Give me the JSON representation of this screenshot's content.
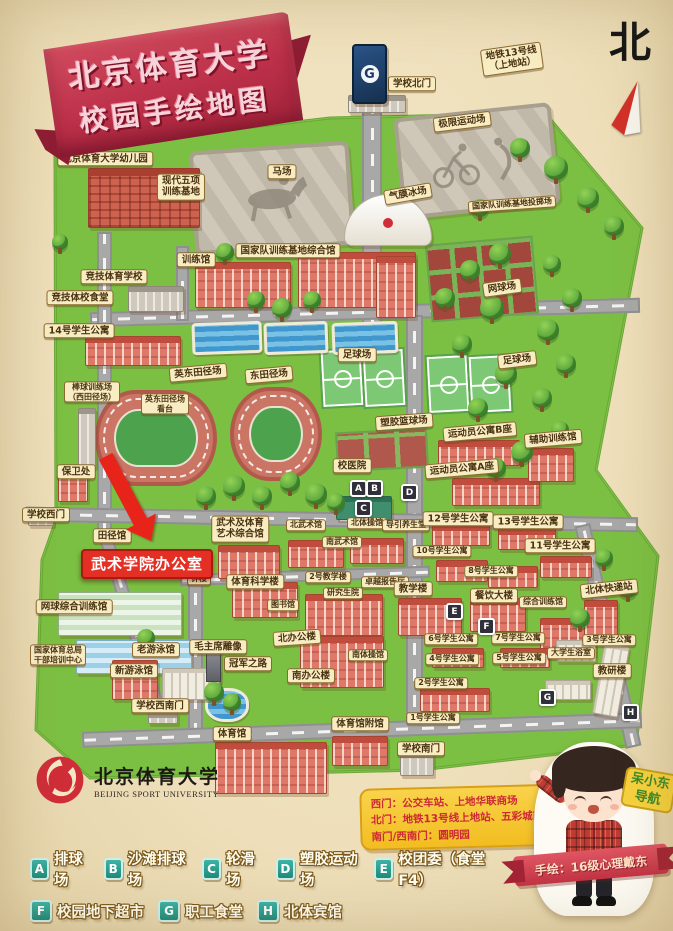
{
  "title": {
    "line1": "北京体育大学",
    "line2": "校园手绘地图"
  },
  "compass": {
    "north_char": "北"
  },
  "metro": {
    "logo": "G",
    "label": "地铁13号线\n（上地站）"
  },
  "logo": {
    "cn": "北京体育大学",
    "en": "BEIJING SPORT UNIVERSITY"
  },
  "gate_info": {
    "lines": [
      "西门：公交车站、上地华联商场",
      "北门：地铁13号线上地站、五彩城商场",
      "南门/西南门：圆明园"
    ]
  },
  "character": {
    "tag": "呆小东\n导航",
    "credit": "手绘：16级心理戴东"
  },
  "legend": {
    "rows": [
      [
        {
          "k": "A",
          "t": "排球场"
        },
        {
          "k": "B",
          "t": "沙滩排球场"
        },
        {
          "k": "C",
          "t": "轮滑场"
        },
        {
          "k": "D",
          "t": "塑胶运动场"
        },
        {
          "k": "E",
          "t": "校团委（食堂F4）"
        }
      ],
      [
        {
          "k": "F",
          "t": "校园地下超市"
        },
        {
          "k": "G",
          "t": "职工食堂"
        },
        {
          "k": "H",
          "t": "北体宾馆"
        }
      ]
    ]
  },
  "colors": {
    "banner_red": "#bc3049",
    "tag_bg": "#f8ecc3",
    "highlight_red": "#e42f24",
    "campus_green": "#7cc043",
    "road_gray": "#a8a8a8",
    "legend_teal": "#2aa198",
    "bubble_yellow": "#f2bd20",
    "bubble_text": "#cc2936",
    "metro_blue": "#1b3a63"
  },
  "map_labels": [
    {
      "text": "北京体育大学幼儿园",
      "x": 105,
      "y": 159
    },
    {
      "text": "现代五项\n训练基地",
      "x": 181,
      "y": 187
    },
    {
      "text": "马场",
      "x": 282,
      "y": 172
    },
    {
      "text": "学校北门",
      "x": 412,
      "y": 84
    },
    {
      "text": "地铁13号线\n（上地站）",
      "x": 512,
      "y": 59,
      "r": -8
    },
    {
      "text": "极限运动场",
      "x": 462,
      "y": 122,
      "r": -7
    },
    {
      "text": "气膜冰场",
      "x": 408,
      "y": 194,
      "r": -10
    },
    {
      "text": "国家队训练基地投掷场",
      "x": 512,
      "y": 204,
      "r": -4,
      "cls": "small"
    },
    {
      "text": "国家队训练基地综合馆",
      "x": 288,
      "y": 251
    },
    {
      "text": "训练馆",
      "x": 196,
      "y": 260
    },
    {
      "text": "竞技体育学校",
      "x": 114,
      "y": 277
    },
    {
      "text": "竞技体校食堂",
      "x": 80,
      "y": 298
    },
    {
      "text": "14号学生公寓",
      "x": 79,
      "y": 331
    },
    {
      "text": "网球场",
      "x": 502,
      "y": 288,
      "r": -8
    },
    {
      "text": "棒球训练场\n（西田径场）",
      "x": 92,
      "y": 392,
      "cls": "small"
    },
    {
      "text": "英东田径场",
      "x": 198,
      "y": 373,
      "r": -5
    },
    {
      "text": "东田径场",
      "x": 269,
      "y": 375,
      "r": -5
    },
    {
      "text": "英东田径场\n看台",
      "x": 165,
      "y": 404,
      "cls": "small"
    },
    {
      "text": "足球场",
      "x": 357,
      "y": 355
    },
    {
      "text": "足球场",
      "x": 517,
      "y": 360,
      "r": -7
    },
    {
      "text": "塑胶篮球场",
      "x": 404,
      "y": 422,
      "r": -4
    },
    {
      "text": "校医院",
      "x": 352,
      "y": 466
    },
    {
      "text": "运动员公寓B座",
      "x": 480,
      "y": 432,
      "r": -5
    },
    {
      "text": "运动员公寓A座",
      "x": 462,
      "y": 469,
      "r": -5
    },
    {
      "text": "辅助训练馆",
      "x": 553,
      "y": 439,
      "r": -5
    },
    {
      "text": "保卫处",
      "x": 76,
      "y": 472
    },
    {
      "text": "学校西门",
      "x": 46,
      "y": 515
    },
    {
      "text": "武术及体育\n艺术综合馆",
      "x": 240,
      "y": 529
    },
    {
      "text": "北武术馆",
      "x": 306,
      "y": 525,
      "cls": "small"
    },
    {
      "text": "北体操馆",
      "x": 367,
      "y": 523,
      "cls": "small"
    },
    {
      "text": "导引养生堂",
      "x": 406,
      "y": 525,
      "cls": "small"
    },
    {
      "text": "南武术馆",
      "x": 342,
      "y": 542,
      "cls": "small"
    },
    {
      "text": "田径馆",
      "x": 112,
      "y": 536
    },
    {
      "text": "钟楼",
      "x": 199,
      "y": 579,
      "cls": "small"
    },
    {
      "text": "体育科学楼",
      "x": 255,
      "y": 582
    },
    {
      "text": "2号教学楼",
      "x": 328,
      "y": 577,
      "cls": "small"
    },
    {
      "text": "卓越报告厅",
      "x": 385,
      "y": 582,
      "cls": "small"
    },
    {
      "text": "研究生院",
      "x": 343,
      "y": 593,
      "cls": "small"
    },
    {
      "text": "图书馆",
      "x": 283,
      "y": 605,
      "cls": "small"
    },
    {
      "text": "教学楼",
      "x": 413,
      "y": 589
    },
    {
      "text": "北办公楼",
      "x": 297,
      "y": 638,
      "r": -4
    },
    {
      "text": "毛主席雕像",
      "x": 218,
      "y": 647
    },
    {
      "text": "冠军之路",
      "x": 248,
      "y": 664
    },
    {
      "text": "南办公楼",
      "x": 311,
      "y": 676
    },
    {
      "text": "南体操馆",
      "x": 368,
      "y": 655,
      "cls": "small"
    },
    {
      "text": "老游泳馆",
      "x": 156,
      "y": 650
    },
    {
      "text": "新游泳馆",
      "x": 134,
      "y": 671
    },
    {
      "text": "网球综合训练馆",
      "x": 74,
      "y": 607
    },
    {
      "text": "国家体育总局\n干部培训中心",
      "x": 58,
      "y": 655,
      "cls": "small"
    },
    {
      "text": "学校西南门",
      "x": 160,
      "y": 706
    },
    {
      "text": "体育馆",
      "x": 232,
      "y": 734
    },
    {
      "text": "体育馆附馆",
      "x": 360,
      "y": 724
    },
    {
      "text": "学校南门",
      "x": 421,
      "y": 749
    },
    {
      "text": "12号学生公寓",
      "x": 458,
      "y": 519
    },
    {
      "text": "13号学生公寓",
      "x": 528,
      "y": 522
    },
    {
      "text": "11号学生公寓",
      "x": 560,
      "y": 546
    },
    {
      "text": "10号学生公寓",
      "x": 442,
      "y": 551,
      "cls": "small"
    },
    {
      "text": "8号学生公寓",
      "x": 491,
      "y": 571,
      "cls": "small"
    },
    {
      "text": "餐饮大楼",
      "x": 494,
      "y": 596
    },
    {
      "text": "综合训练馆",
      "x": 543,
      "y": 602,
      "cls": "small"
    },
    {
      "text": "6号学生公寓",
      "x": 451,
      "y": 639,
      "cls": "small"
    },
    {
      "text": "7号学生公寓",
      "x": 518,
      "y": 638,
      "cls": "small"
    },
    {
      "text": "4号学生公寓",
      "x": 452,
      "y": 659,
      "cls": "small"
    },
    {
      "text": "5号学生公寓",
      "x": 519,
      "y": 658,
      "cls": "small"
    },
    {
      "text": "2号学生公寓",
      "x": 441,
      "y": 683,
      "cls": "small"
    },
    {
      "text": "1号学生公寓",
      "x": 433,
      "y": 718,
      "cls": "small"
    },
    {
      "text": "3号学生公寓",
      "x": 609,
      "y": 640,
      "cls": "small"
    },
    {
      "text": "大学生浴室",
      "x": 571,
      "y": 653,
      "cls": "small"
    },
    {
      "text": "教研楼",
      "x": 612,
      "y": 671
    },
    {
      "text": "北体快递站",
      "x": 609,
      "y": 589,
      "r": -6
    },
    {
      "text": "武术学院办公室",
      "x": 147,
      "y": 564,
      "cls": "highlight"
    }
  ],
  "markers": [
    {
      "k": "A",
      "x": 358,
      "y": 488
    },
    {
      "k": "B",
      "x": 374,
      "y": 488
    },
    {
      "k": "C",
      "x": 363,
      "y": 508
    },
    {
      "k": "D",
      "x": 409,
      "y": 492
    },
    {
      "k": "E",
      "x": 454,
      "y": 611
    },
    {
      "k": "F",
      "x": 486,
      "y": 626
    },
    {
      "k": "G",
      "x": 547,
      "y": 697
    },
    {
      "k": "H",
      "x": 630,
      "y": 712
    }
  ],
  "decor": {
    "buildings": [
      [
        88,
        168,
        112,
        60,
        "brick"
      ],
      [
        195,
        262,
        96,
        46,
        "red"
      ],
      [
        298,
        252,
        118,
        56,
        "red"
      ],
      [
        128,
        286,
        56,
        26,
        "gray"
      ],
      [
        85,
        336,
        96,
        30,
        "red"
      ],
      [
        376,
        256,
        40,
        62,
        "red"
      ],
      [
        58,
        470,
        30,
        32,
        "red"
      ],
      [
        344,
        194,
        88,
        52,
        "dome"
      ],
      [
        348,
        95,
        58,
        18,
        "gray"
      ],
      [
        438,
        440,
        82,
        26,
        "red"
      ],
      [
        452,
        478,
        88,
        28,
        "red"
      ],
      [
        528,
        448,
        46,
        34,
        "red"
      ],
      [
        336,
        496,
        56,
        24,
        "greenb"
      ],
      [
        288,
        540,
        56,
        28,
        "red"
      ],
      [
        350,
        538,
        54,
        26,
        "red"
      ],
      [
        218,
        545,
        62,
        34,
        "red"
      ],
      [
        232,
        582,
        66,
        36,
        "red"
      ],
      [
        305,
        594,
        78,
        42,
        "red"
      ],
      [
        398,
        598,
        64,
        38,
        "red"
      ],
      [
        300,
        636,
        84,
        52,
        "red"
      ],
      [
        470,
        598,
        56,
        34,
        "red"
      ],
      [
        540,
        618,
        56,
        38,
        "red"
      ],
      [
        432,
        524,
        58,
        22,
        "red"
      ],
      [
        498,
        528,
        58,
        22,
        "red"
      ],
      [
        540,
        556,
        52,
        22,
        "red"
      ],
      [
        436,
        560,
        52,
        22,
        "red"
      ],
      [
        488,
        566,
        50,
        22,
        "red"
      ],
      [
        432,
        648,
        52,
        20,
        "red"
      ],
      [
        500,
        648,
        50,
        20,
        "red"
      ],
      [
        58,
        592,
        124,
        44,
        "glass"
      ],
      [
        76,
        640,
        116,
        34,
        "glassblue"
      ],
      [
        112,
        660,
        46,
        40,
        "red"
      ],
      [
        162,
        668,
        58,
        32,
        "white"
      ],
      [
        215,
        742,
        112,
        52,
        "red"
      ],
      [
        332,
        736,
        56,
        30,
        "red"
      ],
      [
        598,
        644,
        26,
        72,
        "white",
        10
      ],
      [
        584,
        600,
        34,
        36,
        "red"
      ],
      [
        556,
        640,
        40,
        22,
        "white"
      ],
      [
        420,
        688,
        70,
        24,
        "red"
      ],
      [
        78,
        408,
        18,
        60,
        "gray"
      ],
      [
        545,
        680,
        46,
        20,
        "white"
      ],
      [
        400,
        752,
        34,
        24,
        "gray"
      ],
      [
        28,
        508,
        26,
        18,
        "gray"
      ],
      [
        148,
        712,
        30,
        12,
        "gray"
      ],
      [
        206,
        650,
        15,
        32,
        "statue"
      ]
    ],
    "trees": [
      [
        520,
        148,
        20
      ],
      [
        556,
        168,
        24
      ],
      [
        588,
        198,
        22
      ],
      [
        614,
        226,
        20
      ],
      [
        480,
        208,
        18
      ],
      [
        500,
        254,
        22
      ],
      [
        470,
        270,
        20
      ],
      [
        445,
        298,
        20
      ],
      [
        492,
        308,
        24
      ],
      [
        462,
        344,
        20
      ],
      [
        506,
        374,
        22
      ],
      [
        478,
        408,
        20
      ],
      [
        522,
        452,
        22
      ],
      [
        496,
        468,
        20
      ],
      [
        552,
        264,
        18
      ],
      [
        572,
        298,
        20
      ],
      [
        548,
        330,
        22
      ],
      [
        566,
        364,
        20
      ],
      [
        542,
        398,
        20
      ],
      [
        560,
        430,
        18
      ],
      [
        256,
        300,
        18
      ],
      [
        282,
        308,
        20
      ],
      [
        312,
        300,
        18
      ],
      [
        206,
        496,
        20
      ],
      [
        234,
        486,
        22
      ],
      [
        262,
        496,
        20
      ],
      [
        290,
        482,
        20
      ],
      [
        316,
        494,
        22
      ],
      [
        336,
        502,
        18
      ],
      [
        146,
        638,
        18
      ],
      [
        214,
        692,
        20
      ],
      [
        232,
        702,
        18
      ],
      [
        580,
        618,
        20
      ],
      [
        604,
        558,
        18
      ],
      [
        628,
        588,
        20
      ],
      [
        225,
        252,
        18
      ],
      [
        60,
        242,
        16
      ]
    ]
  }
}
